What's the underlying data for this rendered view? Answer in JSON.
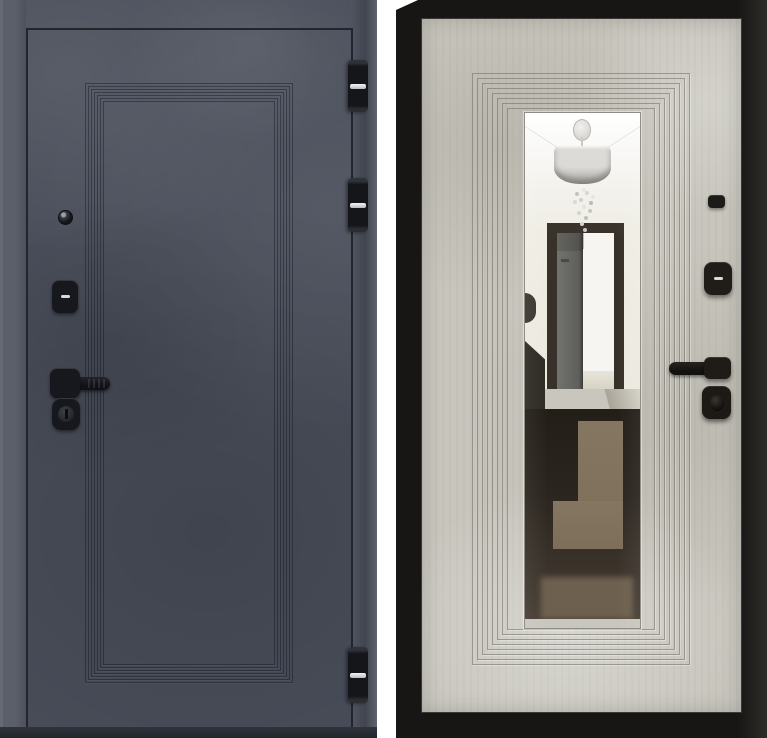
{
  "scene": {
    "type": "product photo",
    "subject": "steel entry door shown from both sides, side by side on white background",
    "text_content": "none"
  },
  "left_panel": {
    "name": "door-exterior-side",
    "finish": "dark graphite concrete texture",
    "panel_style": "stepped rectangular molding with mitered corners",
    "hardware": {
      "peephole": "round door viewer",
      "lock_cover": "black square escutcheon with key slot",
      "handle": "black lever handle on square rose",
      "cylinder": "round key cylinder below handle"
    },
    "hinges_visible": 3
  },
  "right_panel": {
    "name": "door-interior-side",
    "finish": "light beige concrete texture",
    "frame": "black door frame around leaf",
    "panel_style": "stepped rectangular molding around full-length mirror",
    "mirror_reflection": {
      "items": [
        "white ceiling with cove",
        "drum-shade crystal chandelier",
        "open dark doorway with gray door leaf",
        "dark glossy floor with brown geometric rug pattern"
      ]
    },
    "hardware": {
      "latch_button": "small square cover",
      "lock_cover": "square escutcheon with key slot",
      "handle": "black lever handle on square rose",
      "thumb_turn": "square thumb-turn below handle"
    }
  },
  "colors": {
    "bg": "#ffffff",
    "left_face": "#4a4f5b",
    "left_edge": "#5a5f6a",
    "left_line": "#22252d",
    "left_bottom": "#30333b",
    "ring_left": "#141824",
    "hw_black": "#17181d",
    "hw_slot": "#d9dadc",
    "right_frame": "#171614",
    "right_face": "#c7c5bc",
    "ring_right": "#6f6c63",
    "mirror_ceiling": "#f4f3ee",
    "mirror_wall": "#ebe9de",
    "doorway_frame": "#38312a",
    "open_door": "#72726f",
    "interior_white": "#f6f5f1",
    "floor_dark": "#2b251f",
    "floor_rug": "#7d6e5a",
    "floor_brown": "#6e604e",
    "floor_strip": "#c9c6bd",
    "shade_top": "#d9d8d4",
    "shade_bottom": "#a8a6a2"
  }
}
